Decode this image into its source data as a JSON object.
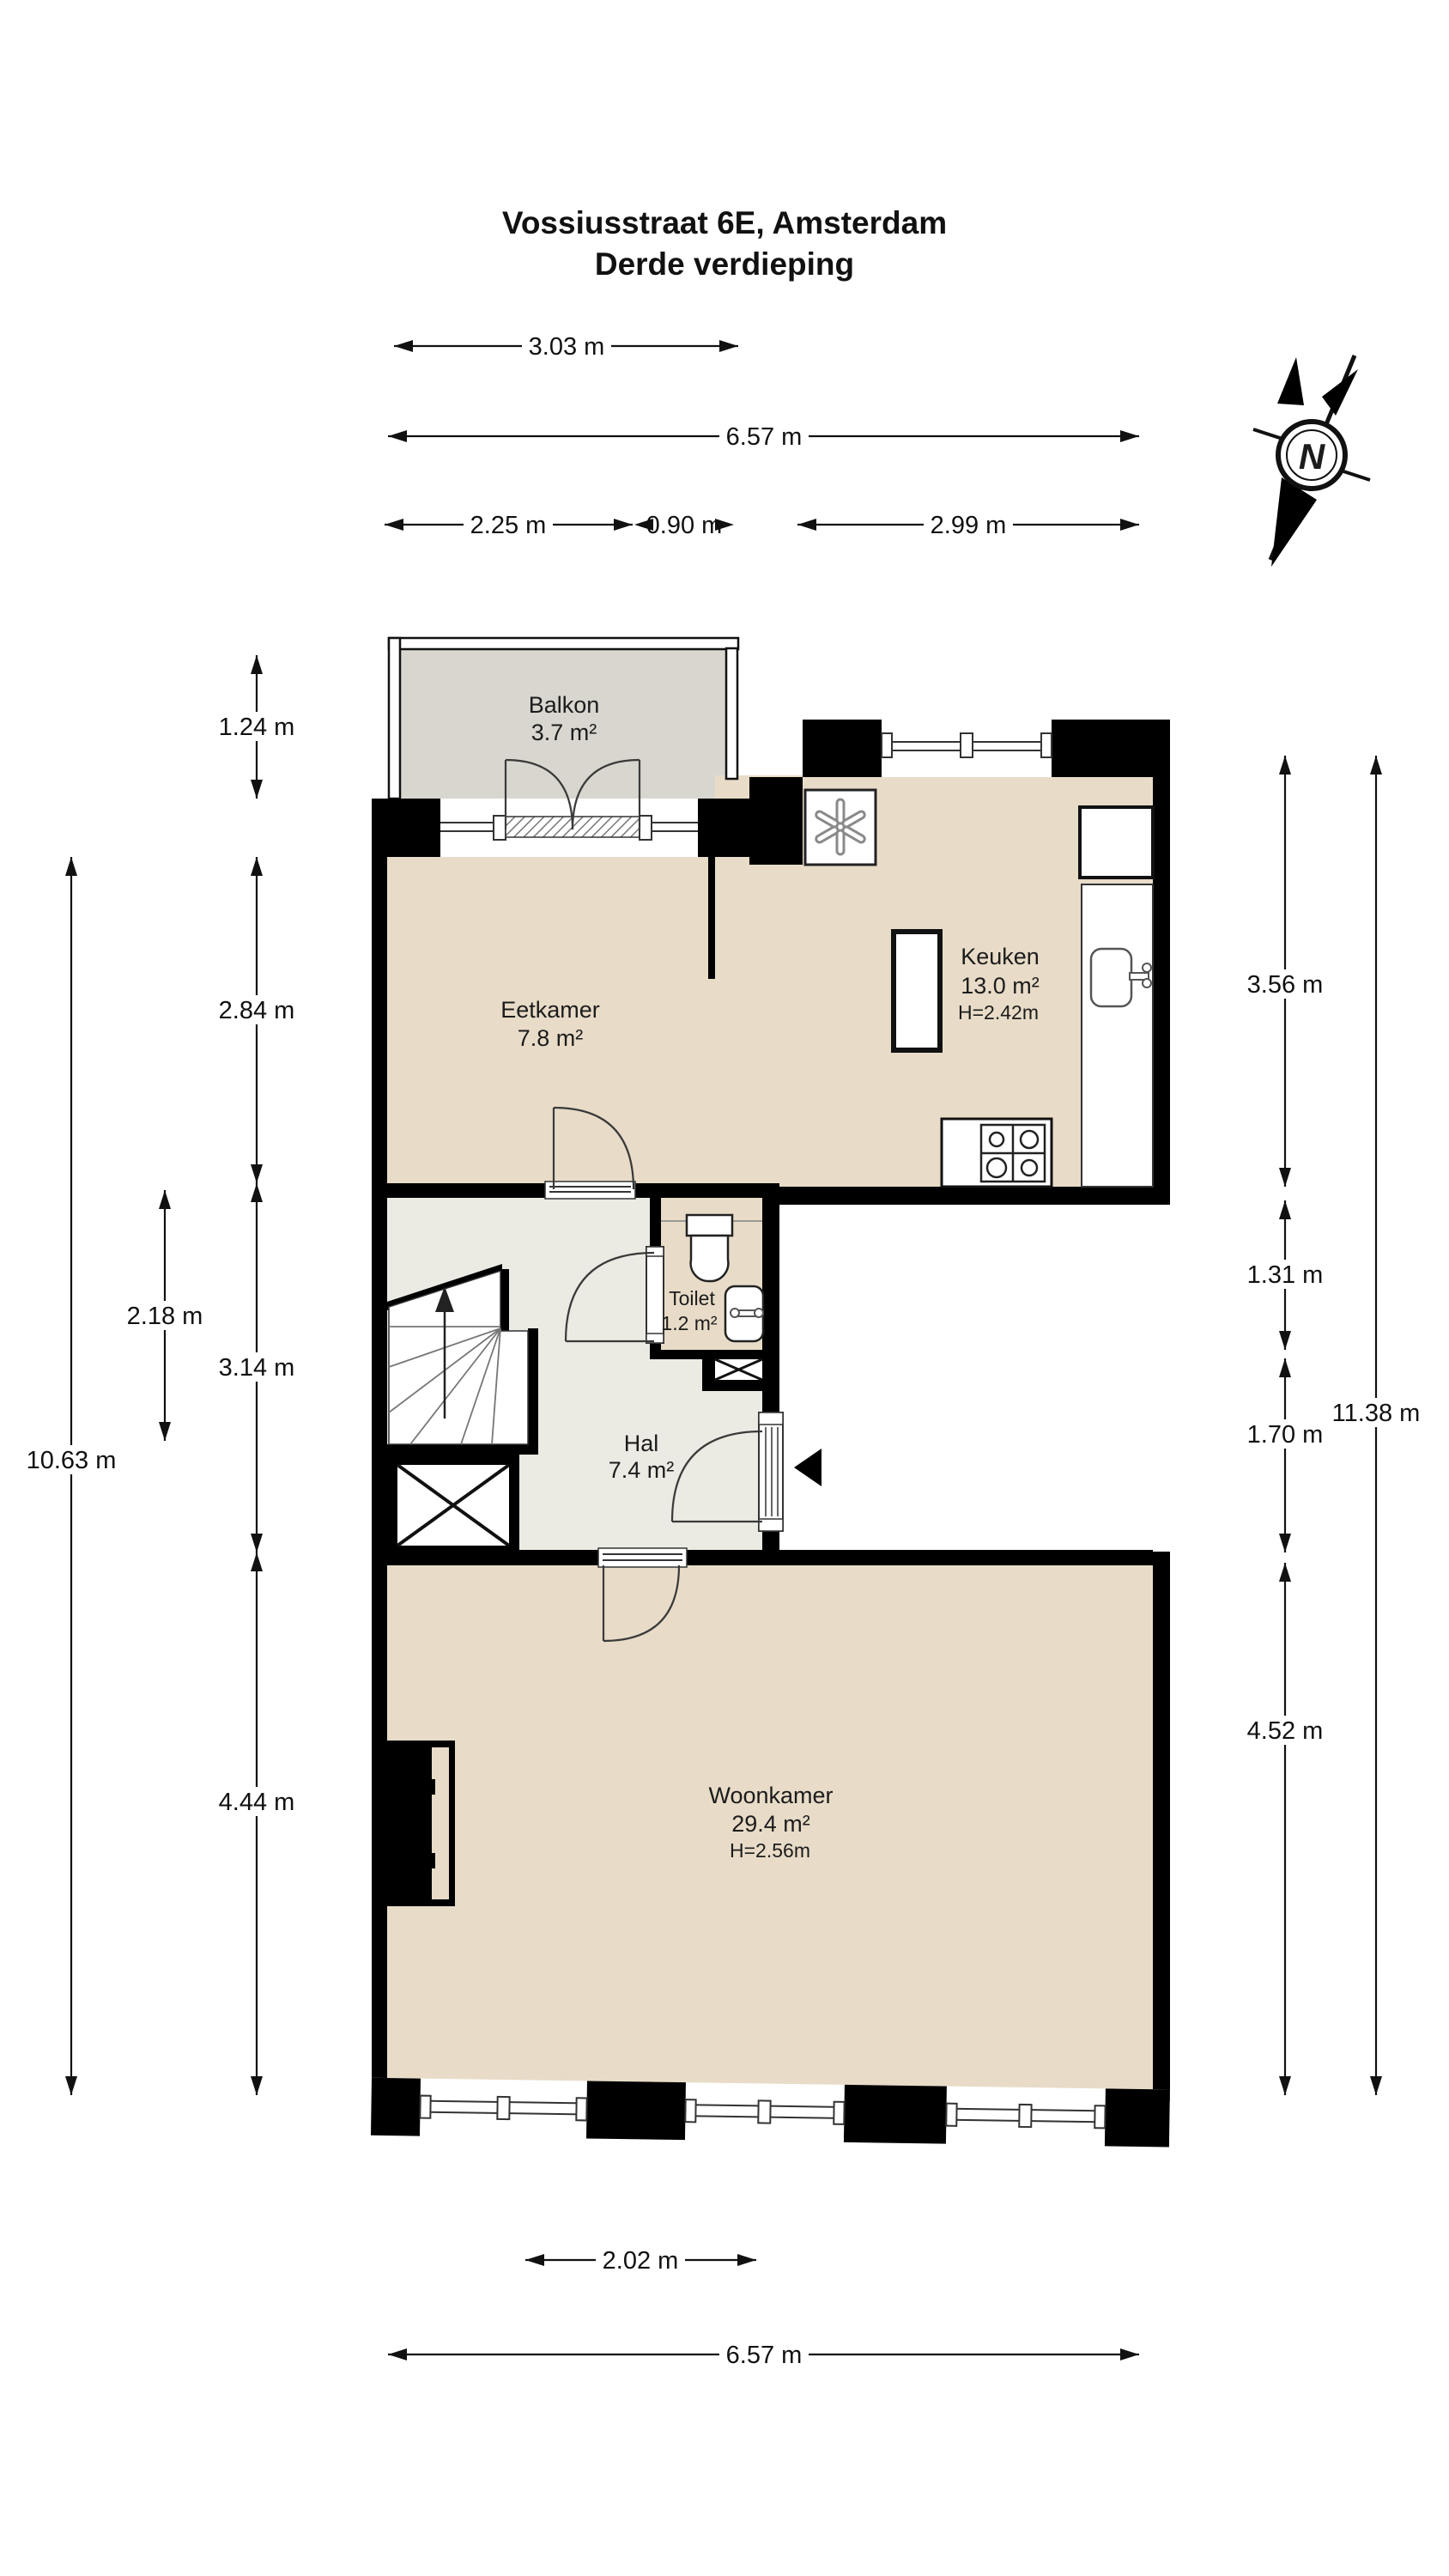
{
  "title": {
    "line1": "Vossiusstraat 6E, Amsterdam",
    "line2": "Derde verdieping"
  },
  "compass": {
    "label": "N"
  },
  "rooms": {
    "balkon": {
      "name": "Balkon",
      "area": "3.7 m²"
    },
    "keuken": {
      "name": "Keuken",
      "area": "13.0 m²",
      "height": "H=2.42m"
    },
    "eetkamer": {
      "name": "Eetkamer",
      "area": "7.8 m²"
    },
    "toilet": {
      "name": "Toilet",
      "area": "1.2 m²"
    },
    "hal": {
      "name": "Hal",
      "area": "7.4 m²"
    },
    "woonkamer": {
      "name": "Woonkamer",
      "area": "29.4 m²",
      "height": "H=2.56m"
    }
  },
  "dims": {
    "top_balkon": "3.03 m",
    "top_total": "6.57 m",
    "top_a": "2.25 m",
    "top_b": "0.90 m",
    "top_c": "2.99 m",
    "left_balkon": "1.24 m",
    "left_eetkamer": "2.84 m",
    "left_hal": "3.14 m",
    "left_woonkamer": "4.44 m",
    "left_stairs": "2.18 m",
    "left_total": "10.63 m",
    "right_keuken": "3.56 m",
    "right_toilet": "1.31 m",
    "right_hal": "1.70 m",
    "right_woonkamer": "4.52 m",
    "right_total": "11.38 m",
    "bottom_window": "2.02 m",
    "bottom_total": "6.57 m"
  },
  "colors": {
    "wall": "#000000",
    "floor": "#e8dcc8",
    "floor_hal": "#ebeae3",
    "balkon": "#d8d6ce",
    "line": "#333333"
  }
}
